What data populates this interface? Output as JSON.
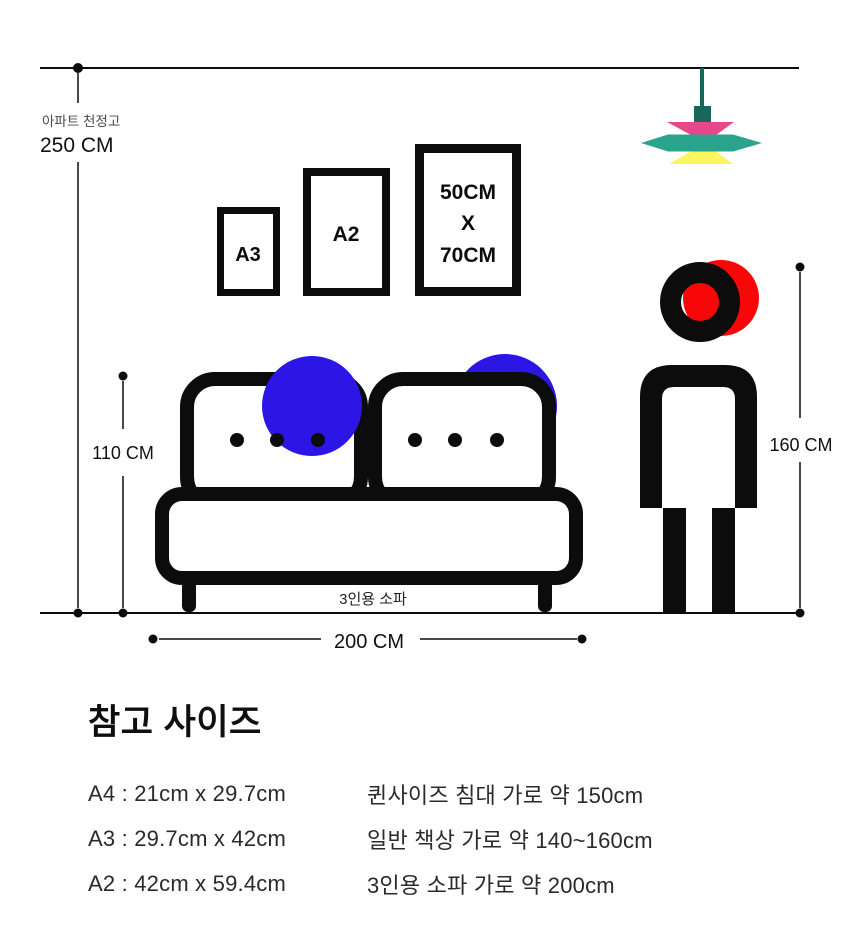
{
  "scene": {
    "ceiling": {
      "caption": "아파트 천정고",
      "height_label": "250 CM"
    },
    "frames": {
      "a3_label": "A3",
      "a2_label": "A2",
      "poster_line1": "50CM",
      "poster_line2": "X",
      "poster_line3": "70CM"
    },
    "sofa": {
      "label": "3인용 소파",
      "height_label": "110 CM",
      "width_label": "200 CM"
    },
    "person": {
      "height_label": "160 CM"
    }
  },
  "reference": {
    "title": "참고 사이즈",
    "rows": [
      {
        "size": "A4 : 21cm x 29.7cm",
        "desc": "퀸사이즈 침대 가로  약 150cm"
      },
      {
        "size": "A3 : 29.7cm x 42cm",
        "desc": "일반 책상 가로  약 140~160cm"
      },
      {
        "size": "A2 : 42cm x 59.4cm",
        "desc": "3인용 소파 가로  약 200cm"
      }
    ]
  },
  "colors": {
    "ink": "#0c0c0c",
    "blue": "#2b16e6",
    "red": "#f70707",
    "lamp_pink": "#e8478b",
    "lamp_teal": "#2aa38d",
    "lamp_yellow": "#fbf55e",
    "lamp_stem": "#17685a"
  }
}
